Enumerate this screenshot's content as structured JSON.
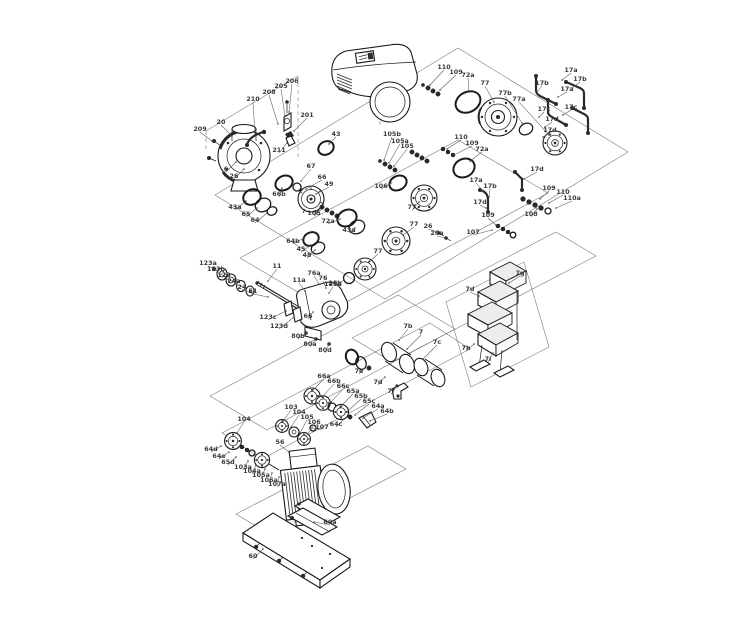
{
  "page": {
    "background": "#ffffff"
  },
  "diagram": {
    "kind": "exploded-parts-diagram",
    "ink_color": "#1a1a1a",
    "label_color": "#3a3a3a",
    "callouts": [
      {
        "label": "209",
        "x": 200,
        "y": 131,
        "ex": 212,
        "ey": 141
      },
      {
        "label": "20",
        "x": 221,
        "y": 124,
        "ex": 231,
        "ey": 135
      },
      {
        "label": "210",
        "x": 253,
        "y": 101,
        "ex": 255,
        "ey": 134
      },
      {
        "label": "208",
        "x": 269,
        "y": 94,
        "ex": 278,
        "ey": 124
      },
      {
        "label": "205",
        "x": 281,
        "y": 88,
        "ex": 285,
        "ey": 116
      },
      {
        "label": "206",
        "x": 292,
        "y": 83,
        "ex": 289,
        "ey": 112
      },
      {
        "label": "201",
        "x": 307,
        "y": 117,
        "ex": 294,
        "ey": 131
      },
      {
        "label": "211",
        "x": 279,
        "y": 152,
        "ex": 287,
        "ey": 143
      },
      {
        "label": "6",
        "x": 226,
        "y": 171,
        "ex": 236,
        "ey": 162
      },
      {
        "label": "26",
        "x": 234,
        "y": 178,
        "ex": 244,
        "ey": 169
      },
      {
        "label": "43",
        "x": 336,
        "y": 136,
        "ex": 329,
        "ey": 144
      },
      {
        "label": "110",
        "x": 444,
        "y": 69,
        "ex": 430,
        "ey": 85
      },
      {
        "label": "109",
        "x": 456,
        "y": 74,
        "ex": 440,
        "ey": 90
      },
      {
        "label": "72a",
        "x": 468,
        "y": 77,
        "ex": 469,
        "ey": 92
      },
      {
        "label": "77",
        "x": 485,
        "y": 85,
        "ex": 494,
        "ey": 102
      },
      {
        "label": "77b",
        "x": 505,
        "y": 95,
        "ex": 522,
        "ey": 123
      },
      {
        "label": "77a",
        "x": 519,
        "y": 101,
        "ex": 549,
        "ey": 135
      },
      {
        "label": "17a",
        "x": 571,
        "y": 72,
        "ex": 562,
        "ey": 80
      },
      {
        "label": "17b",
        "x": 580,
        "y": 81,
        "ex": 572,
        "ey": 88
      },
      {
        "label": "17a",
        "x": 567,
        "y": 91,
        "ex": 558,
        "ey": 97
      },
      {
        "label": "17b",
        "x": 542,
        "y": 85,
        "ex": 537,
        "ey": 92
      },
      {
        "label": "17c",
        "x": 571,
        "y": 109,
        "ex": 563,
        "ey": 115
      },
      {
        "label": "17c",
        "x": 544,
        "y": 111,
        "ex": 539,
        "ey": 117
      },
      {
        "label": "17d",
        "x": 552,
        "y": 121,
        "ex": 545,
        "ey": 127
      },
      {
        "label": "17d",
        "x": 550,
        "y": 132,
        "ex": 543,
        "ey": 137
      },
      {
        "label": "67",
        "x": 311,
        "y": 168,
        "ex": 301,
        "ey": 181
      },
      {
        "label": "66",
        "x": 322,
        "y": 179,
        "ex": 306,
        "ey": 189
      },
      {
        "label": "49",
        "x": 329,
        "y": 186,
        "ex": 316,
        "ey": 194
      },
      {
        "label": "43a",
        "x": 235,
        "y": 209,
        "ex": 246,
        "ey": 201
      },
      {
        "label": "65",
        "x": 246,
        "y": 216,
        "ex": 257,
        "ey": 208
      },
      {
        "label": "64",
        "x": 255,
        "y": 222,
        "ex": 267,
        "ey": 213
      },
      {
        "label": "66b",
        "x": 279,
        "y": 196,
        "ex": 282,
        "ey": 188
      },
      {
        "label": "105",
        "x": 314,
        "y": 215,
        "ex": 322,
        "ey": 209
      },
      {
        "label": "72a",
        "x": 328,
        "y": 223,
        "ex": 340,
        "ey": 219
      },
      {
        "label": "43a",
        "x": 349,
        "y": 232,
        "ex": 355,
        "ey": 228
      },
      {
        "label": "64b",
        "x": 293,
        "y": 243,
        "ex": 304,
        "ey": 238
      },
      {
        "label": "45",
        "x": 301,
        "y": 251,
        "ex": 311,
        "ey": 245
      },
      {
        "label": "48",
        "x": 307,
        "y": 257,
        "ex": 315,
        "ey": 250
      },
      {
        "label": "77",
        "x": 414,
        "y": 226,
        "ex": 403,
        "ey": 235
      },
      {
        "label": "26",
        "x": 428,
        "y": 228,
        "ex": 438,
        "ey": 232
      },
      {
        "label": "26a",
        "x": 437,
        "y": 235,
        "ex": 445,
        "ey": 238
      },
      {
        "label": "77",
        "x": 378,
        "y": 253,
        "ex": 369,
        "ey": 262
      },
      {
        "label": "26b",
        "x": 335,
        "y": 285,
        "ex": 344,
        "ey": 280
      },
      {
        "label": "105b",
        "x": 392,
        "y": 136,
        "ex": 384,
        "ey": 160
      },
      {
        "label": "105a",
        "x": 400,
        "y": 143,
        "ex": 389,
        "ey": 163
      },
      {
        "label": "105",
        "x": 407,
        "y": 148,
        "ex": 394,
        "ey": 166
      },
      {
        "label": "110",
        "x": 461,
        "y": 139,
        "ex": 447,
        "ey": 149
      },
      {
        "label": "109",
        "x": 472,
        "y": 145,
        "ex": 454,
        "ey": 155
      },
      {
        "label": "72a",
        "x": 482,
        "y": 151,
        "ex": 470,
        "ey": 161
      },
      {
        "label": "106",
        "x": 381,
        "y": 188,
        "ex": 391,
        "ey": 183
      },
      {
        "label": "77",
        "x": 412,
        "y": 209,
        "ex": 419,
        "ey": 202
      },
      {
        "label": "17a",
        "x": 476,
        "y": 182,
        "ex": 483,
        "ey": 191
      },
      {
        "label": "17b",
        "x": 490,
        "y": 188,
        "ex": 489,
        "ey": 197
      },
      {
        "label": "17d",
        "x": 480,
        "y": 204,
        "ex": 486,
        "ey": 208
      },
      {
        "label": "109",
        "x": 488,
        "y": 217,
        "ex": 496,
        "ey": 225
      },
      {
        "label": "107",
        "x": 473,
        "y": 234,
        "ex": 492,
        "ey": 230
      },
      {
        "label": "109",
        "x": 549,
        "y": 190,
        "ex": 540,
        "ey": 199
      },
      {
        "label": "110",
        "x": 563,
        "y": 194,
        "ex": 549,
        "ey": 203
      },
      {
        "label": "110a",
        "x": 572,
        "y": 200,
        "ex": 556,
        "ey": 208
      },
      {
        "label": "108",
        "x": 531,
        "y": 216,
        "ex": 537,
        "ey": 209
      },
      {
        "label": "17d",
        "x": 537,
        "y": 171,
        "ex": 524,
        "ey": 179
      },
      {
        "label": "7g",
        "x": 520,
        "y": 275,
        "ex": 509,
        "ey": 283
      },
      {
        "label": "7d",
        "x": 470,
        "y": 291,
        "ex": 479,
        "ey": 296
      },
      {
        "label": "7h",
        "x": 466,
        "y": 350,
        "ex": 474,
        "ey": 344
      },
      {
        "label": "7i",
        "x": 488,
        "y": 361,
        "ex": 493,
        "ey": 353
      },
      {
        "label": "7b",
        "x": 408,
        "y": 328,
        "ex": 399,
        "ey": 340
      },
      {
        "label": "7",
        "x": 421,
        "y": 334,
        "ex": 407,
        "ey": 349
      },
      {
        "label": "7c",
        "x": 437,
        "y": 344,
        "ex": 423,
        "ey": 359
      },
      {
        "label": "7e",
        "x": 359,
        "y": 373,
        "ex": 366,
        "ey": 366
      },
      {
        "label": "7d",
        "x": 378,
        "y": 384,
        "ex": 385,
        "ey": 377
      },
      {
        "label": "7f",
        "x": 391,
        "y": 393,
        "ex": 397,
        "ey": 386
      },
      {
        "label": "123a",
        "x": 208,
        "y": 265,
        "ex": 218,
        "ey": 271
      },
      {
        "label": "123b",
        "x": 216,
        "y": 271,
        "ex": 227,
        "ey": 277
      },
      {
        "label": "123",
        "x": 224,
        "y": 277,
        "ex": 237,
        "ey": 283
      },
      {
        "label": "24a",
        "x": 234,
        "y": 283,
        "ex": 246,
        "ey": 288
      },
      {
        "label": "24",
        "x": 242,
        "y": 289,
        "ex": 252,
        "ey": 293
      },
      {
        "label": "11",
        "x": 277,
        "y": 268,
        "ex": 268,
        "ey": 281
      },
      {
        "label": "11a",
        "x": 299,
        "y": 282,
        "ex": 305,
        "ey": 291
      },
      {
        "label": "51",
        "x": 253,
        "y": 293,
        "ex": 268,
        "ey": 297
      },
      {
        "label": "76a",
        "x": 314,
        "y": 275,
        "ex": 319,
        "ey": 284
      },
      {
        "label": "76",
        "x": 323,
        "y": 280,
        "ex": 326,
        "ey": 288
      },
      {
        "label": "123a",
        "x": 333,
        "y": 286,
        "ex": 329,
        "ey": 293
      },
      {
        "label": "66",
        "x": 308,
        "y": 318,
        "ex": 313,
        "ey": 312
      },
      {
        "label": "123c",
        "x": 268,
        "y": 319,
        "ex": 286,
        "ey": 311
      },
      {
        "label": "123d",
        "x": 279,
        "y": 328,
        "ex": 294,
        "ey": 317
      },
      {
        "label": "80b",
        "x": 298,
        "y": 338,
        "ex": 306,
        "ey": 333
      },
      {
        "label": "80a",
        "x": 310,
        "y": 346,
        "ex": 316,
        "ey": 339
      },
      {
        "label": "80d",
        "x": 325,
        "y": 352,
        "ex": 329,
        "ey": 344
      },
      {
        "label": "66a",
        "x": 324,
        "y": 378,
        "ex": 313,
        "ey": 390
      },
      {
        "label": "66b",
        "x": 334,
        "y": 383,
        "ex": 322,
        "ey": 397
      },
      {
        "label": "66c",
        "x": 343,
        "y": 388,
        "ex": 331,
        "ey": 402
      },
      {
        "label": "65a",
        "x": 353,
        "y": 393,
        "ex": 340,
        "ey": 407
      },
      {
        "label": "65b",
        "x": 361,
        "y": 398,
        "ex": 348,
        "ey": 411
      },
      {
        "label": "65c",
        "x": 369,
        "y": 403,
        "ex": 355,
        "ey": 415
      },
      {
        "label": "64a",
        "x": 378,
        "y": 408,
        "ex": 363,
        "ey": 418
      },
      {
        "label": "64b",
        "x": 387,
        "y": 413,
        "ex": 370,
        "ey": 421
      },
      {
        "label": "64c",
        "x": 336,
        "y": 426,
        "ex": 344,
        "ey": 419
      },
      {
        "label": "104",
        "x": 244,
        "y": 421,
        "ex": 237,
        "ey": 433
      },
      {
        "label": "103",
        "x": 291,
        "y": 409,
        "ex": 283,
        "ey": 421
      },
      {
        "label": "104",
        "x": 299,
        "y": 414,
        "ex": 291,
        "ey": 427
      },
      {
        "label": "105",
        "x": 307,
        "y": 419,
        "ex": 300,
        "ey": 433
      },
      {
        "label": "106",
        "x": 314,
        "y": 424,
        "ex": 306,
        "ey": 436
      },
      {
        "label": "107",
        "x": 322,
        "y": 429,
        "ex": 312,
        "ey": 428
      },
      {
        "label": "64d",
        "x": 211,
        "y": 451,
        "ex": 221,
        "ey": 446
      },
      {
        "label": "64e",
        "x": 219,
        "y": 458,
        "ex": 229,
        "ey": 452
      },
      {
        "label": "65d",
        "x": 228,
        "y": 464,
        "ex": 236,
        "ey": 457
      },
      {
        "label": "103a",
        "x": 243,
        "y": 469,
        "ex": 248,
        "ey": 461
      },
      {
        "label": "104a",
        "x": 252,
        "y": 473,
        "ex": 256,
        "ey": 465
      },
      {
        "label": "105a",
        "x": 261,
        "y": 477,
        "ex": 265,
        "ey": 469
      },
      {
        "label": "106a",
        "x": 269,
        "y": 482,
        "ex": 272,
        "ey": 473
      },
      {
        "label": "107a",
        "x": 277,
        "y": 486,
        "ex": 279,
        "ey": 477
      },
      {
        "label": "56",
        "x": 280,
        "y": 444,
        "ex": 289,
        "ey": 452
      },
      {
        "label": "60a",
        "x": 330,
        "y": 524,
        "ex": 314,
        "ey": 522
      },
      {
        "label": "60",
        "x": 253,
        "y": 558,
        "ex": 263,
        "ey": 549
      }
    ]
  }
}
